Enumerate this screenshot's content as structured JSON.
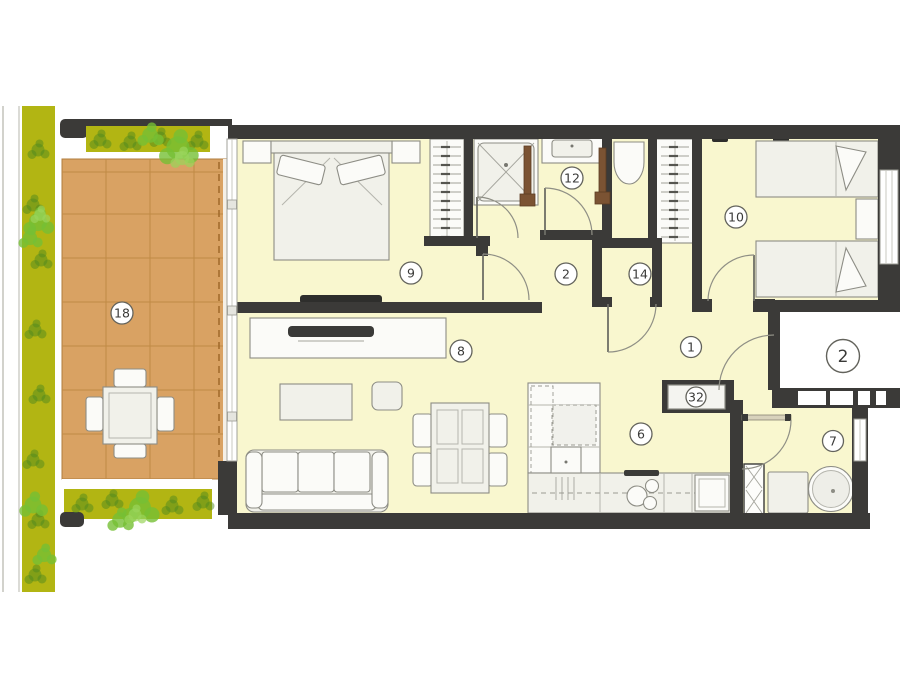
{
  "floorplan": {
    "type": "apartment-floor-plan",
    "unit_label": "2",
    "room_labels": {
      "terrace": "18",
      "main_bedroom": "9",
      "bathroom": "12",
      "hallway": "2",
      "room_14": "14",
      "second_bedroom": "10",
      "entrance_hall": "1",
      "living_room": "8",
      "kitchen": "6",
      "utility": "7",
      "cabinet": "32"
    },
    "colors": {
      "wall": "#3b3a38",
      "interior_floor": "#f9f7cf",
      "terrace_deck": "#d9a263",
      "greenery": "#b2b513",
      "plant_dark": "#4f8a1e",
      "plant_bright": "#76bf35",
      "furniture_fill": "#f4f4f0",
      "furniture_stroke": "#8d8d85",
      "door_leaf_wood": "#7b5333",
      "background": "#ffffff"
    }
  }
}
